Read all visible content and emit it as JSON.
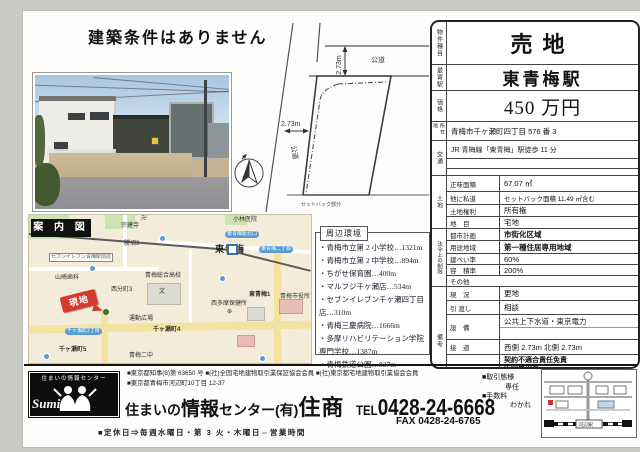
{
  "headline": "建築条件はありません",
  "site_plan": {
    "road_top": "公道",
    "road_left": "公道",
    "dim_top": "2.73m",
    "dim_left": "2.73m",
    "setback": "セットバック部分"
  },
  "map": {
    "title": "案 内 図",
    "marker": "現地",
    "labels": [
      "宗建寺",
      "卍",
      "勝沼3",
      "小林医院",
      "山崎歯科",
      "西分町3",
      "青梅総合高校",
      "文",
      "西多摩保健所",
      "⊕",
      "東青梅1",
      "青梅市役所",
      "千ヶ瀬町4",
      "千ヶ瀬町5",
      "青梅二中",
      "運動広場",
      "東青梅駅北口",
      "東青梅二丁目",
      "千ヶ瀬町2丁目",
      "セブンイレブン青梅駅前店",
      "東青梅"
    ]
  },
  "surroundings": {
    "title": "周辺環境",
    "items": [
      "・青梅市立第 2 小学校…1321m",
      "・青梅市立第 2 中学校…894m",
      "・ちがせ保育園…400m",
      "・マルフジ千ヶ瀬店…534m",
      "・セブンイレブン千ヶ瀬四丁目店…310m",
      "・青梅三慶病院…1666m",
      "・多摩リハビリテーション学院専門学校…1387m",
      "・青梅鉄道公園…837m"
    ]
  },
  "table": {
    "rows_top": [
      {
        "label": "物件種目",
        "value": "売地"
      },
      {
        "label": "最寄駅",
        "value": "東青梅駅"
      },
      {
        "label": "価格",
        "value": "450 万円"
      },
      {
        "label": "所在地",
        "value": "青梅市千ヶ瀬町四丁目 576 番 3"
      },
      {
        "label": "交通",
        "value": "JR 青梅線「東青梅」駅徒歩 11 分"
      }
    ],
    "land_group": "土地",
    "land_rows": [
      {
        "label": "正味面積",
        "value": "67.07 ㎡"
      },
      {
        "label": "他に私道",
        "value": "セットバック面積 11.49 ㎡含む"
      },
      {
        "label": "土地権利",
        "value": "所有権"
      },
      {
        "label": "地　目",
        "value": "宅地"
      }
    ],
    "law_group": "法令上の制限",
    "law_rows": [
      {
        "label": "都市計画",
        "value": "市街化区域"
      },
      {
        "label": "用途地域",
        "value": "第一種住居専用地域"
      },
      {
        "label": "建ぺい率",
        "value": "60%"
      },
      {
        "label": "容　積率",
        "value": "200%"
      },
      {
        "label": "その他",
        "value": ""
      }
    ],
    "remarks_group": "備考",
    "remarks_rows": [
      {
        "label": "現　況",
        "value": "更地"
      },
      {
        "label": "引 渡し",
        "value": "相談"
      },
      {
        "label": "設　備",
        "value": "公共上下水道・東京電力"
      },
      {
        "label": "接　道",
        "value": "西側 2.73m 北側 2.73m"
      }
    ],
    "other_label": "その他",
    "other_lines": [
      "契約不適合責任免責",
      "告知事項有",
      "◆図面と現況に相違の有る場合は",
      "現況を優先とします。"
    ]
  },
  "footer": {
    "license_line1": "■東京都知事(8)第 63650 号 ■(社)全国宅地建物取引業保証協会会員 ■(社)東京都宅地建物取引業協会会員",
    "address_line": "■東京都青梅市河辺町10丁目 12-37",
    "company_pre": "住まいの",
    "company_mid": "情報",
    "company_mid2": "センター(有)",
    "company_name": "住商",
    "tel_label": "TEL",
    "tel_number": "0428-24-6668",
    "fax_line": "FAX 0428-24-6765",
    "deal_label": "■取引態様",
    "deal_value": "専任",
    "fee_label": "■手数料",
    "fee_value": "わかれ",
    "hours_line": "■定休日⇒毎週水曜日・第 3 火・木曜日⇔営業時間",
    "logo_caption": "住まいの情報センター",
    "logo_script": "SumiSho",
    "office_map_station": "河辺駅"
  }
}
